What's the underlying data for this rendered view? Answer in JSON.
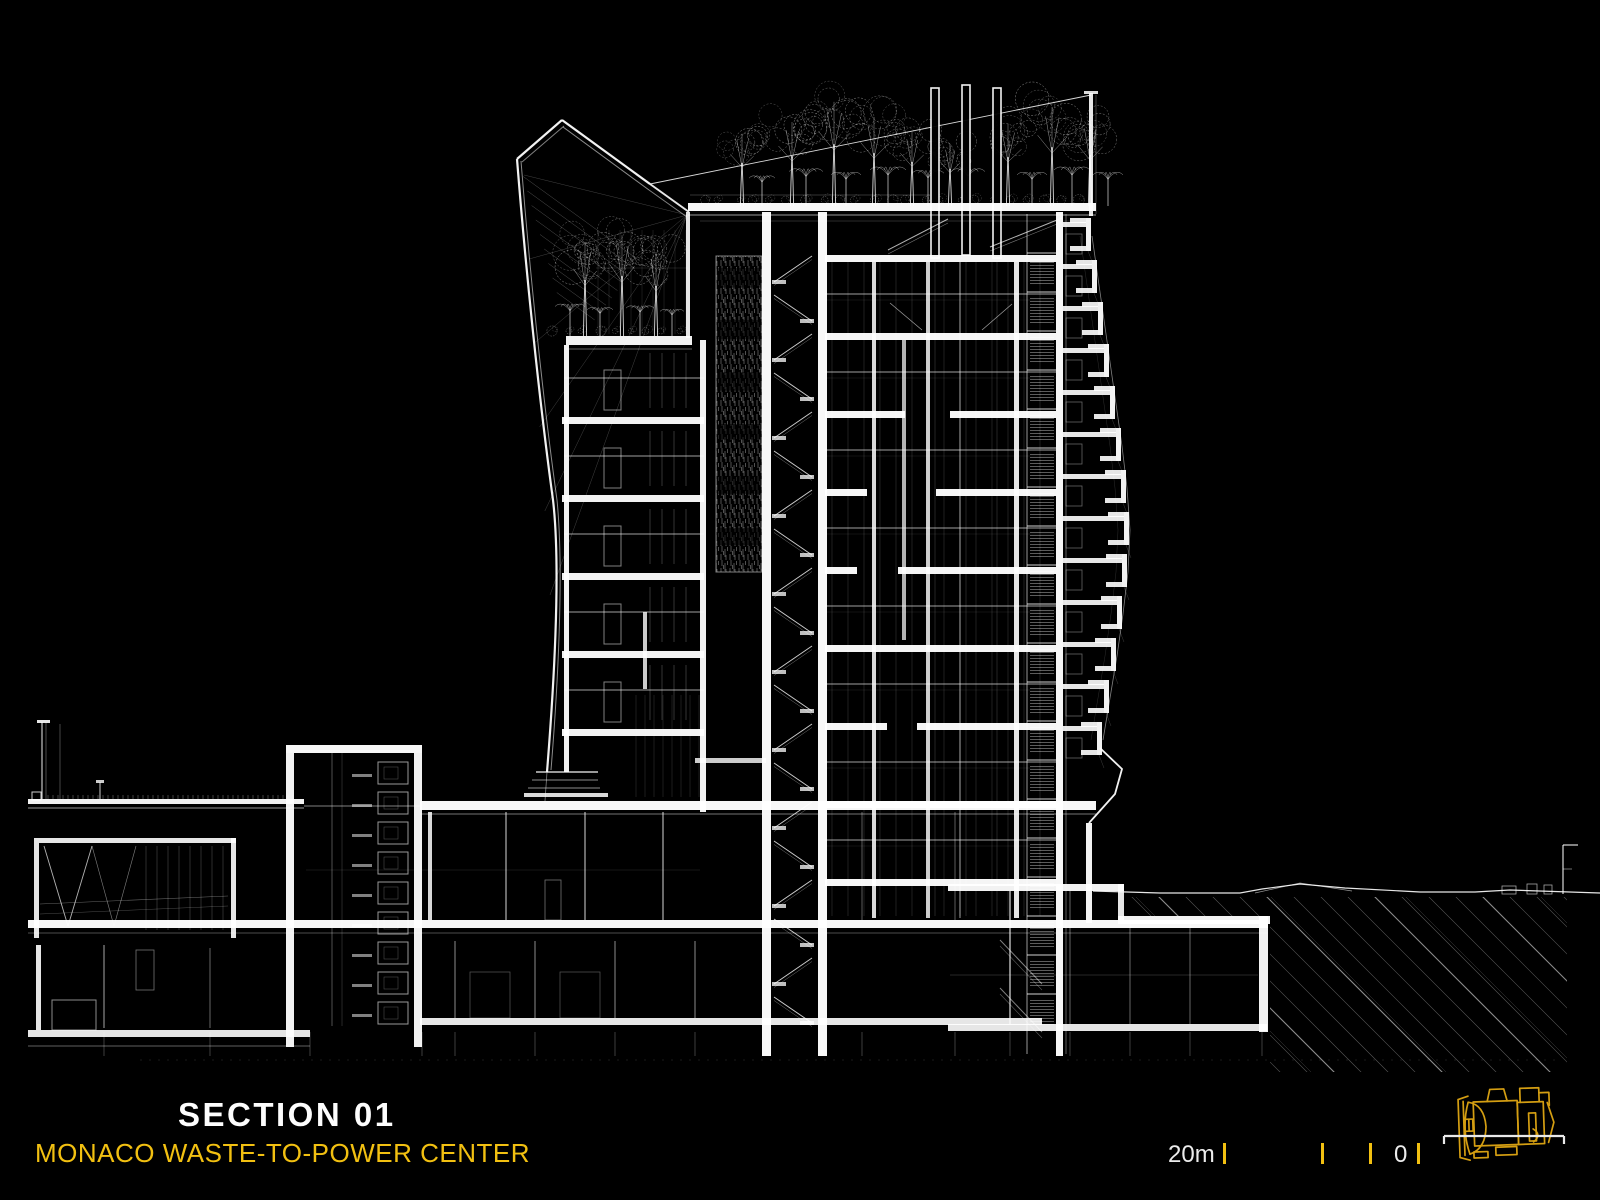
{
  "colors": {
    "background": "#000000",
    "line": "#ffffff",
    "accent": "#f2c011",
    "truck": "#d49e12"
  },
  "title_block": {
    "section_label": "SECTION 01",
    "project_name": "MONACO WASTE-TO-POWER CENTER"
  },
  "scale_bar": {
    "max_label": "20m",
    "zero_label": "0",
    "tick_positions_m": [
      20,
      10,
      5,
      0
    ]
  },
  "icons": {
    "truck": "garbage-truck-plan-icon",
    "section_cut": "section-cut-line"
  }
}
